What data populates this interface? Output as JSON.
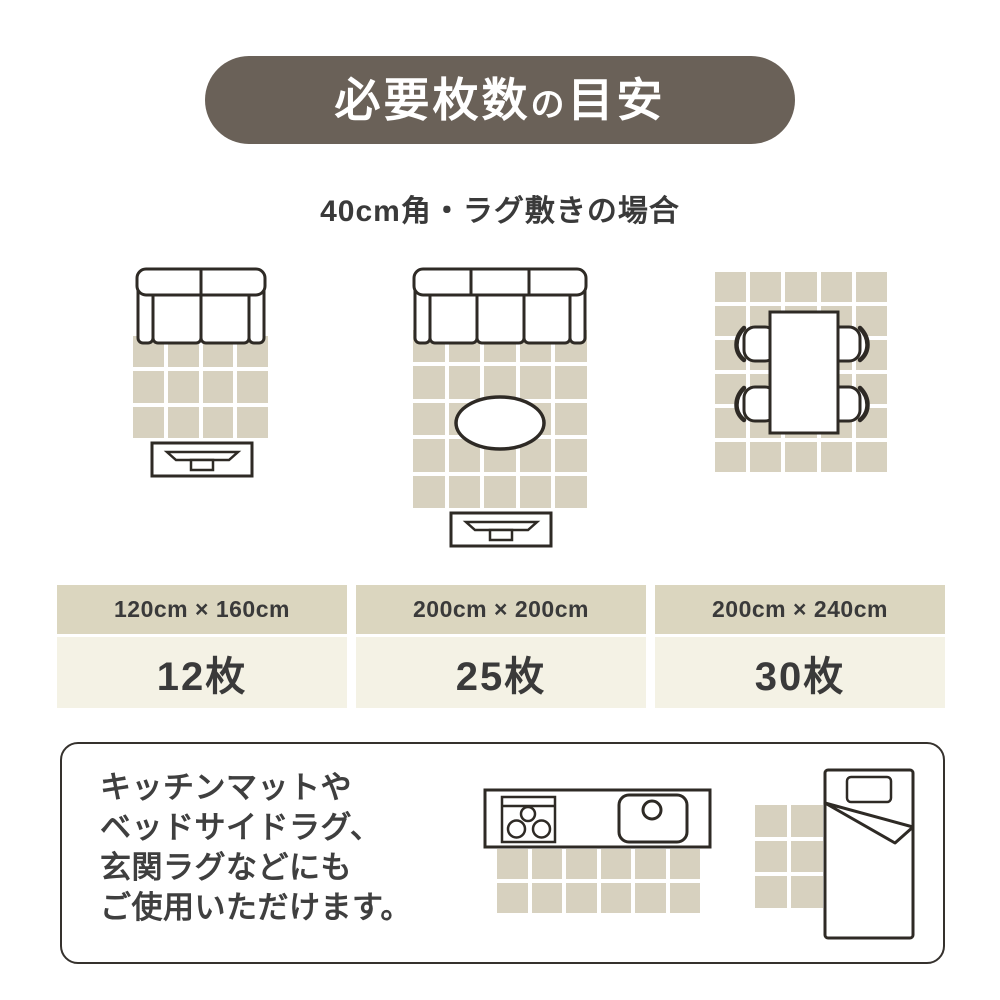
{
  "title": {
    "main": "必要枚数",
    "particle": "の",
    "rest": "目安"
  },
  "subtitle": "40cm角・ラグ敷きの場合",
  "colors": {
    "accent": "#6a6158",
    "tile": "#d7d1bf",
    "header_bg": "#dbd6bf",
    "value_bg": "#f4f2e5",
    "ink": "#3a3a3a",
    "outline": "#2e2a25"
  },
  "diagrams": [
    {
      "name": "sofa-2seat-with-rug-and-tv-board",
      "grid": {
        "cols": 4,
        "rows": 3
      }
    },
    {
      "name": "sofa-3seat-with-rug-oval-table-and-tv-board",
      "grid": {
        "cols": 5,
        "rows": 5
      }
    },
    {
      "name": "dining-table-with-four-chairs-on-rug",
      "grid": {
        "cols": 5,
        "rows": 6
      }
    }
  ],
  "size_table": {
    "columns": [
      {
        "size": "120cm × 160cm",
        "count": "12枚"
      },
      {
        "size": "200cm × 200cm",
        "count": "25枚"
      },
      {
        "size": "200cm × 240cm",
        "count": "30枚"
      }
    ]
  },
  "note": {
    "lines": [
      "キッチンマットや",
      "ベッドサイドラグ、",
      "玄関ラグなどにも",
      "ご使用いただけます。"
    ],
    "illustrations": [
      {
        "name": "kitchen-counter-with-mat",
        "grid": {
          "cols": 6,
          "rows": 2
        }
      },
      {
        "name": "bed-with-bedside-rug",
        "grid": {
          "cols": 2,
          "rows": 3
        }
      }
    ]
  }
}
